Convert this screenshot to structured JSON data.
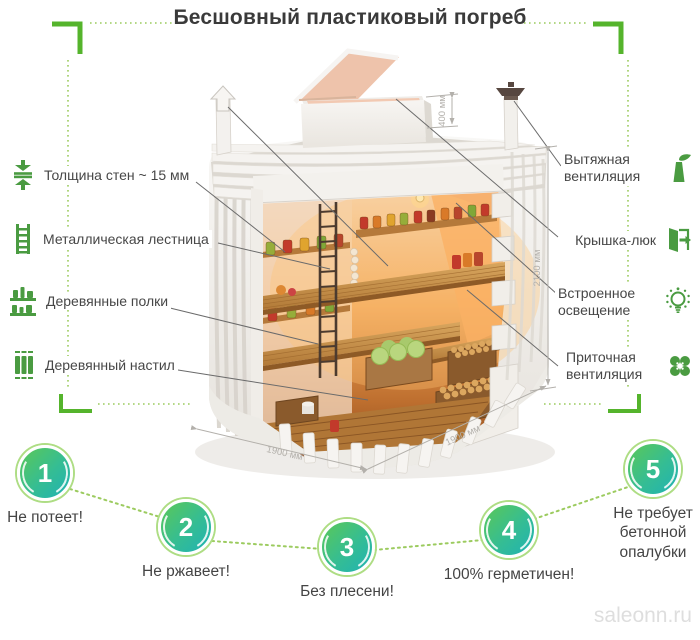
{
  "title": "Бесшовный пластиковый погреб",
  "features_left": [
    {
      "icon": "wall-thickness-icon",
      "label": "Толщина стен ~ 15 мм"
    },
    {
      "icon": "metal-ladder-icon",
      "label": "Металлическая лестница"
    },
    {
      "icon": "wooden-shelves-icon",
      "label": "Деревянные полки"
    },
    {
      "icon": "wooden-decking-icon",
      "label": "Деревянный настил"
    }
  ],
  "features_right": [
    {
      "icon": "exhaust-vent-icon",
      "label": "Вытяжная вентиляция"
    },
    {
      "icon": "hatch-cover-icon",
      "label": "Крышка-люк"
    },
    {
      "icon": "built-in-light-icon",
      "label": "Встроенное освещение"
    },
    {
      "icon": "supply-vent-icon",
      "label": "Приточная вентиляция"
    }
  ],
  "dimensions": {
    "lid_height": "400 мм",
    "inner_height": "2100 мм",
    "width": "1900 мм",
    "depth": "1900 мм"
  },
  "benefits": [
    {
      "number": "1",
      "label": "Не потеет!"
    },
    {
      "number": "2",
      "label": "Не ржавеет!"
    },
    {
      "number": "3",
      "label": "Без плесени!"
    },
    {
      "number": "4",
      "label": "100% герметичен!"
    },
    {
      "number": "5",
      "label": "Не требует бетонной опалубки"
    }
  ],
  "watermark": "saleonn.ru",
  "colors": {
    "accent_green": "#55b42c",
    "icon_green": "#4a9b41",
    "dotted_green": "#9ccb5f",
    "badge_gradient_start": "#58c75c",
    "badge_gradient_end": "#1fb2b4",
    "text": "#4a4a4a"
  }
}
